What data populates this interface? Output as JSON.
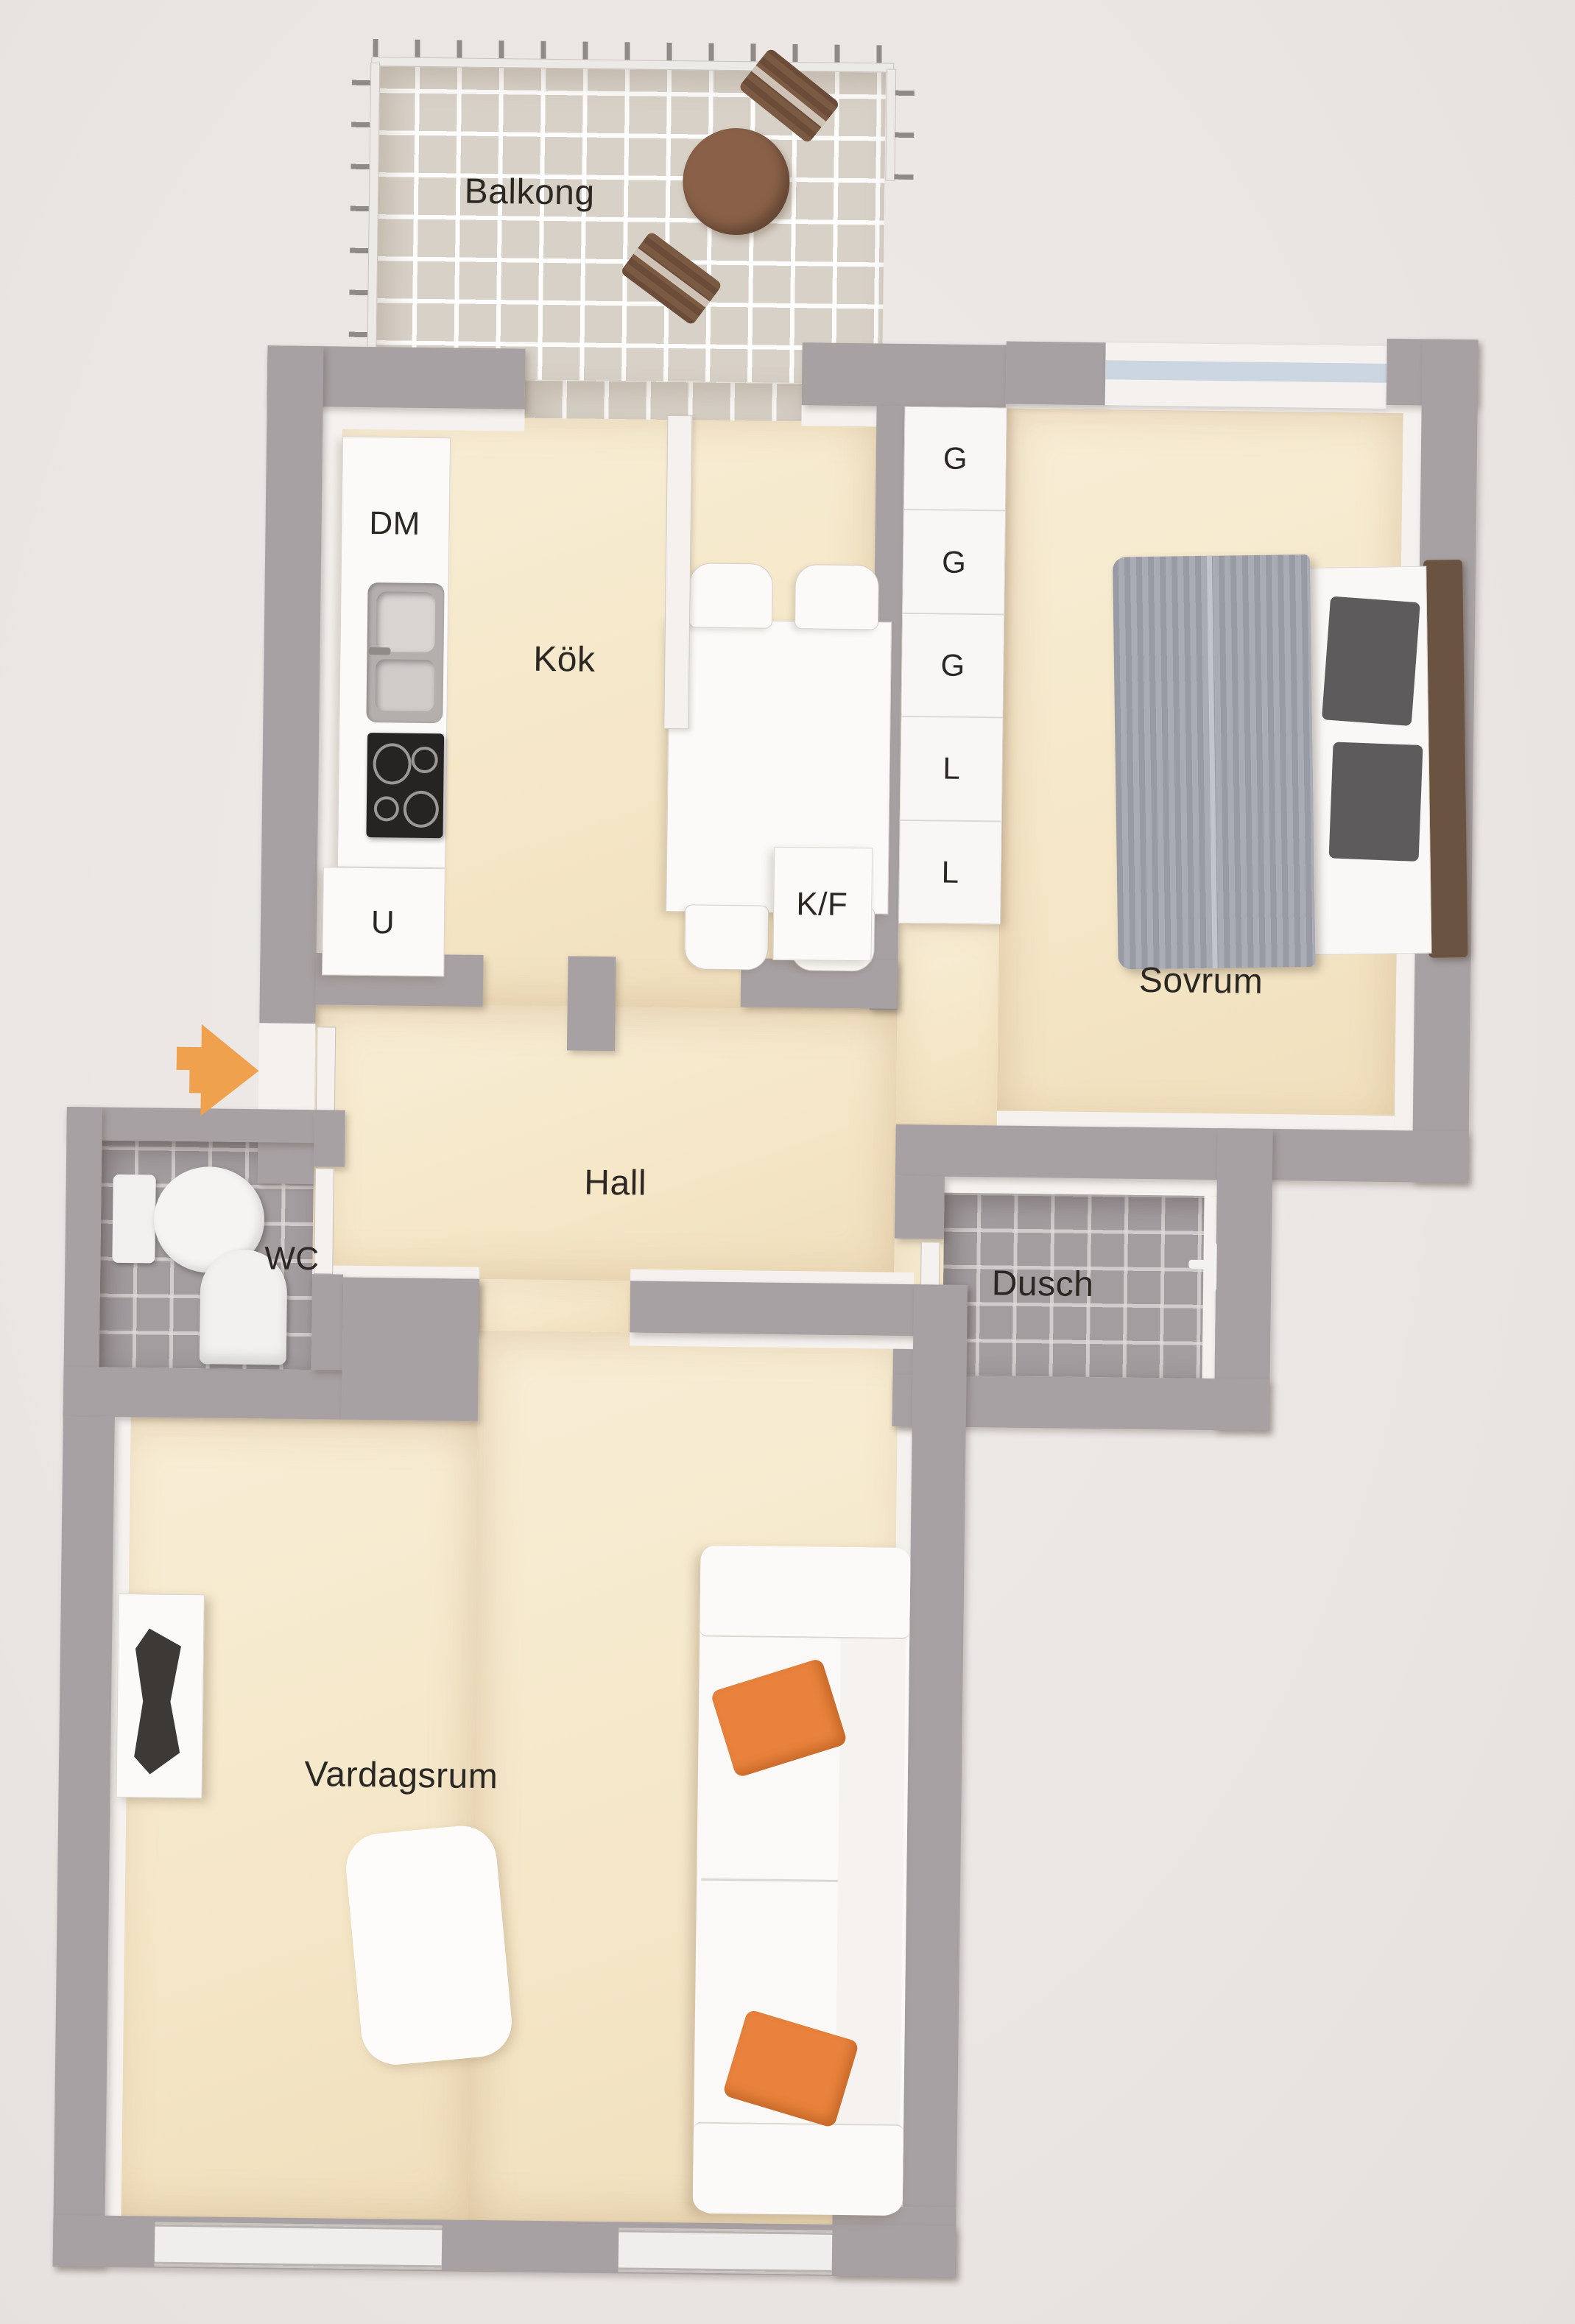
{
  "rooms": {
    "balcony": {
      "label": "Balkong"
    },
    "kitchen": {
      "label": "Kök"
    },
    "bedroom": {
      "label": "Sovrum"
    },
    "hall": {
      "label": "Hall"
    },
    "wc": {
      "label": "WC"
    },
    "shower": {
      "label": "Dusch"
    },
    "living_room": {
      "label": "Vardagsrum"
    }
  },
  "appliances": {
    "dishwasher": "DM",
    "oven": "U",
    "fridge_freezer": "K/F"
  },
  "closets": {
    "items": [
      "G",
      "G",
      "G",
      "L",
      "L"
    ]
  },
  "colors": {
    "wall": "#a7a1a3",
    "wall_face": "#f4f1ee",
    "room_floor": "#f6ead0",
    "balcony_tile": "#d8d1c7",
    "bathroom_tile": "#a39da0",
    "paper_background": "#ebe7e5",
    "sofa_pillow_orange": "#e8823c",
    "entrance_arrow_orange": "#f0a14e",
    "bed_blanket_gray": "#9fa1aa",
    "headboard_wood": "#6b5342",
    "balcony_furniture_wood": "#8a6148",
    "stove_dark": "#262422"
  }
}
